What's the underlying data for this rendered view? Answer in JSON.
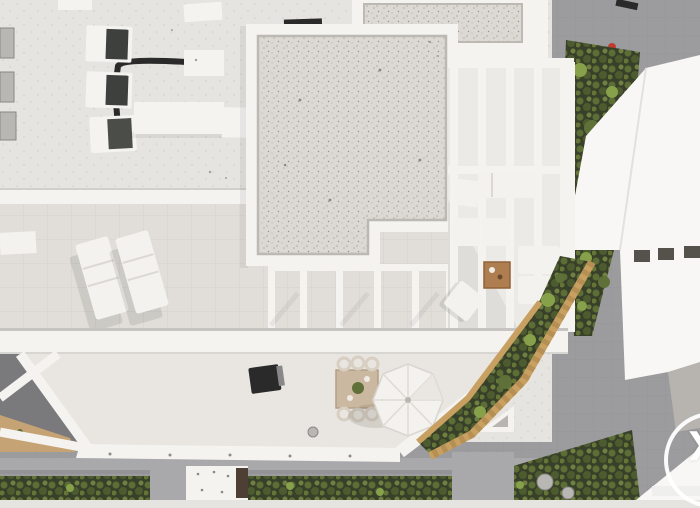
{
  "photo": {
    "kind": "aerial-drone-photograph",
    "subject": "Top-down aerial view of a white modern hotel rooftop with gravel roof sections, tiled sun terraces, a pergola lounge, a dining terrace with parasol, garden beds and concrete walkways",
    "lighting": "daylight, sun from upper right, shadows falling to lower left"
  },
  "carousel": {
    "next_glyph": "❯"
  },
  "scene_inventory": {
    "ac_units": 3,
    "sun_loungers": 2,
    "parasols": 1,
    "dining_tables": 1,
    "coffee_tables": 1,
    "sofa_cushions": 6,
    "barbecue_grills": 1,
    "garden_beds": 3,
    "stepping_stones": 2,
    "roof_vents": 4
  },
  "colors": {
    "roof": "#e6e4e0",
    "terrace_tiles": "#e1ded9",
    "tile_line": "#d2cfca",
    "white_structure": "#f4f3f0",
    "building_white": "#f8f7f5",
    "gravel_base": "#dcd9d4",
    "gravel_edge": "#bcb9b3",
    "pavement": "#9c9c9e",
    "pavement_light": "#a9a8aa",
    "soil_dark": "#39402a",
    "foliage": "#5f7038",
    "foliage_light": "#87a04a",
    "tan_border": "#c8a061",
    "dirt_tan": "#c6a374",
    "wood_table": "#ae7e50",
    "dark_object": "#2a2a2a",
    "furniture_white": "#f3f2ef",
    "arrow_white": "#ffffff"
  }
}
